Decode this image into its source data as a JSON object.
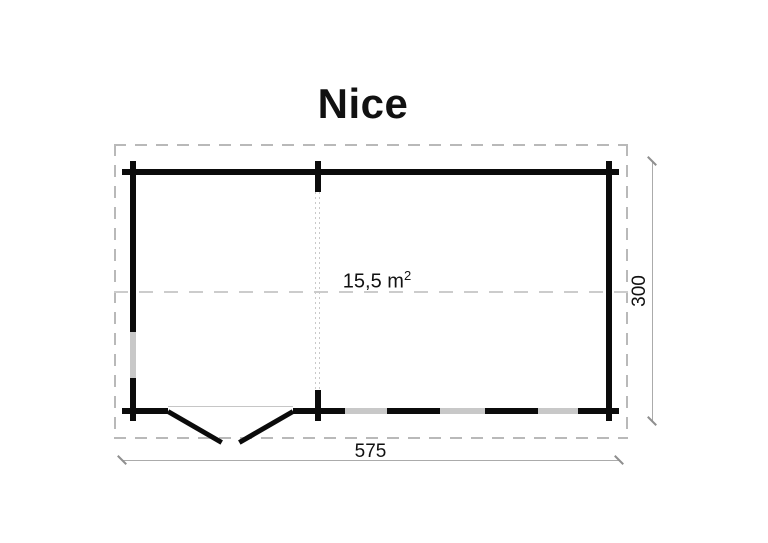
{
  "title": "Nice",
  "floorplan": {
    "area_value": "15,5 m",
    "area_sup": "2",
    "width_dim": "575",
    "height_dim": "300",
    "features": {
      "door": "double swing door, bottom-left wall",
      "windows_bottom_wall": 3,
      "windows_left_wall": 1,
      "partition": "dotted guide line with wall ticks at x-division"
    }
  },
  "colors": {
    "wall": "#0b0b0b",
    "window": "#c8c8c8",
    "roof_outline": "#b9b9b9",
    "centerline": "#cccccc",
    "partition_dotted": "#c9c9c9",
    "dimension_line": "#ababab",
    "dimension_tick": "#8f8f8f",
    "text": "#111111",
    "background": "#ffffff"
  }
}
